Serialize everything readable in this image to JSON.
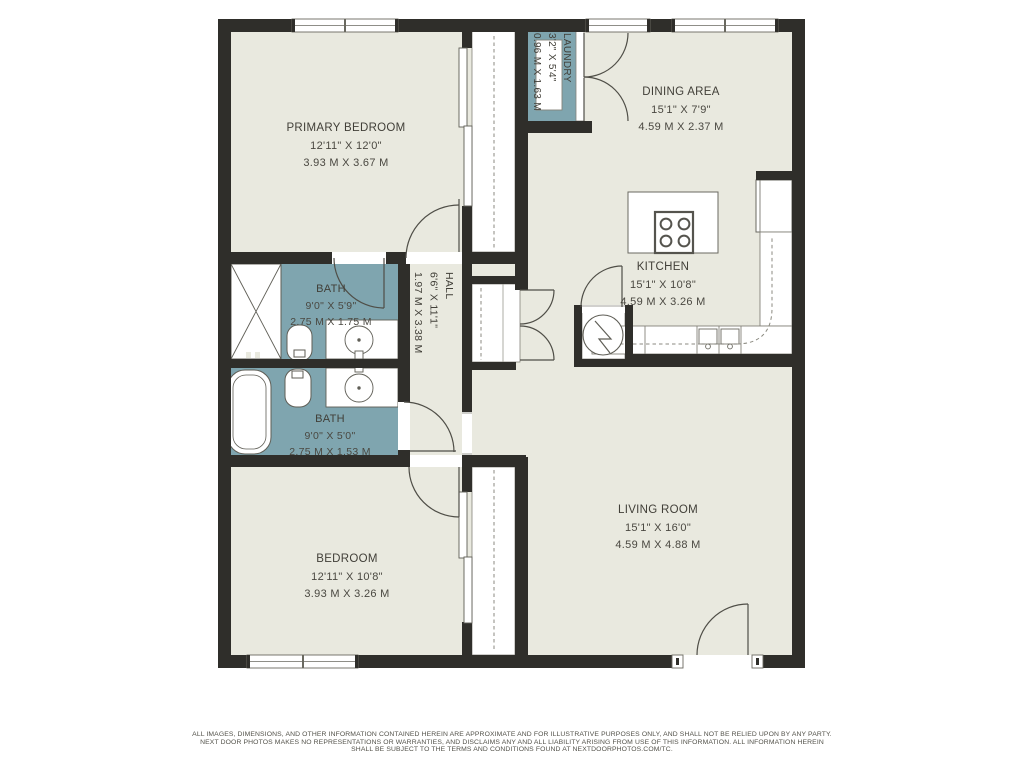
{
  "rooms": {
    "primary_bedroom": {
      "name": "PRIMARY BEDROOM",
      "dimensions_ft": "12'11\" X 12'0\"",
      "dimensions_m": "3.93 M X 3.67 M"
    },
    "dining_area": {
      "name": "DINING AREA",
      "dimensions_ft": "15'1\" X 7'9\"",
      "dimensions_m": "4.59 M X 2.37 M"
    },
    "kitchen": {
      "name": "KITCHEN",
      "dimensions_ft": "15'1\" X 10'8\"",
      "dimensions_m": "4.59 M X 3.26 M"
    },
    "living_room": {
      "name": "LIVING ROOM",
      "dimensions_ft": "15'1\" X 16'0\"",
      "dimensions_m": "4.59 M X 4.88 M"
    },
    "bedroom": {
      "name": "BEDROOM",
      "dimensions_ft": "12'11\" X 10'8\"",
      "dimensions_m": "3.93 M X 3.26 M"
    },
    "bath_primary": {
      "name": "BATH",
      "dimensions_ft": "9'0\" X 5'9\"",
      "dimensions_m": "2.75 M X 1.75 M"
    },
    "bath_hall": {
      "name": "BATH",
      "dimensions_ft": "9'0\" X 5'0\"",
      "dimensions_m": "2.75 M X 1.53 M"
    },
    "hall": {
      "name": "HALL",
      "dimensions_ft": "6'6\" X 11'1\"",
      "dimensions_m": "1.97 M X 3.38 M"
    },
    "laundry": {
      "name": "LAUNDRY",
      "dimensions_ft": "3'2\" X 5'4\"",
      "dimensions_m": "0.96 M X 1.63 M"
    }
  },
  "icons": {
    "stove": "stove-icon",
    "water_heater": "water-heater-icon",
    "shower": "shower-icon",
    "bathtub": "bathtub-icon",
    "toilet": "toilet-icon",
    "sink": "sink-icon",
    "fridge": "fridge-icon",
    "washer_dryer": "washer-dryer-icon"
  },
  "colors": {
    "wall": "#2f2e2a",
    "floor": "#e9e9df",
    "wet_room": "#7fa5af",
    "fixture_line": "#5f5e56",
    "dashed_line": "#8b8a80",
    "text": "#413f38"
  },
  "disclaimer": {
    "line1": "ALL IMAGES, DIMENSIONS, AND OTHER INFORMATION CONTAINED HEREIN ARE APPROXIMATE AND FOR ILLUSTRATIVE PURPOSES ONLY, AND SHALL NOT BE RELIED UPON BY ANY PARTY.",
    "line2": "NEXT DOOR PHOTOS MAKES NO REPRESENTATIONS OR WARRANTIES, AND DISCLAIMS ANY AND ALL LIABILITY ARISING FROM USE OF THIS INFORMATION. ALL INFORMATION HEREIN",
    "line3": "SHALL BE SUBJECT TO THE TERMS AND CONDITIONS FOUND AT NEXTDOORPHOTOS.COM/TC."
  }
}
